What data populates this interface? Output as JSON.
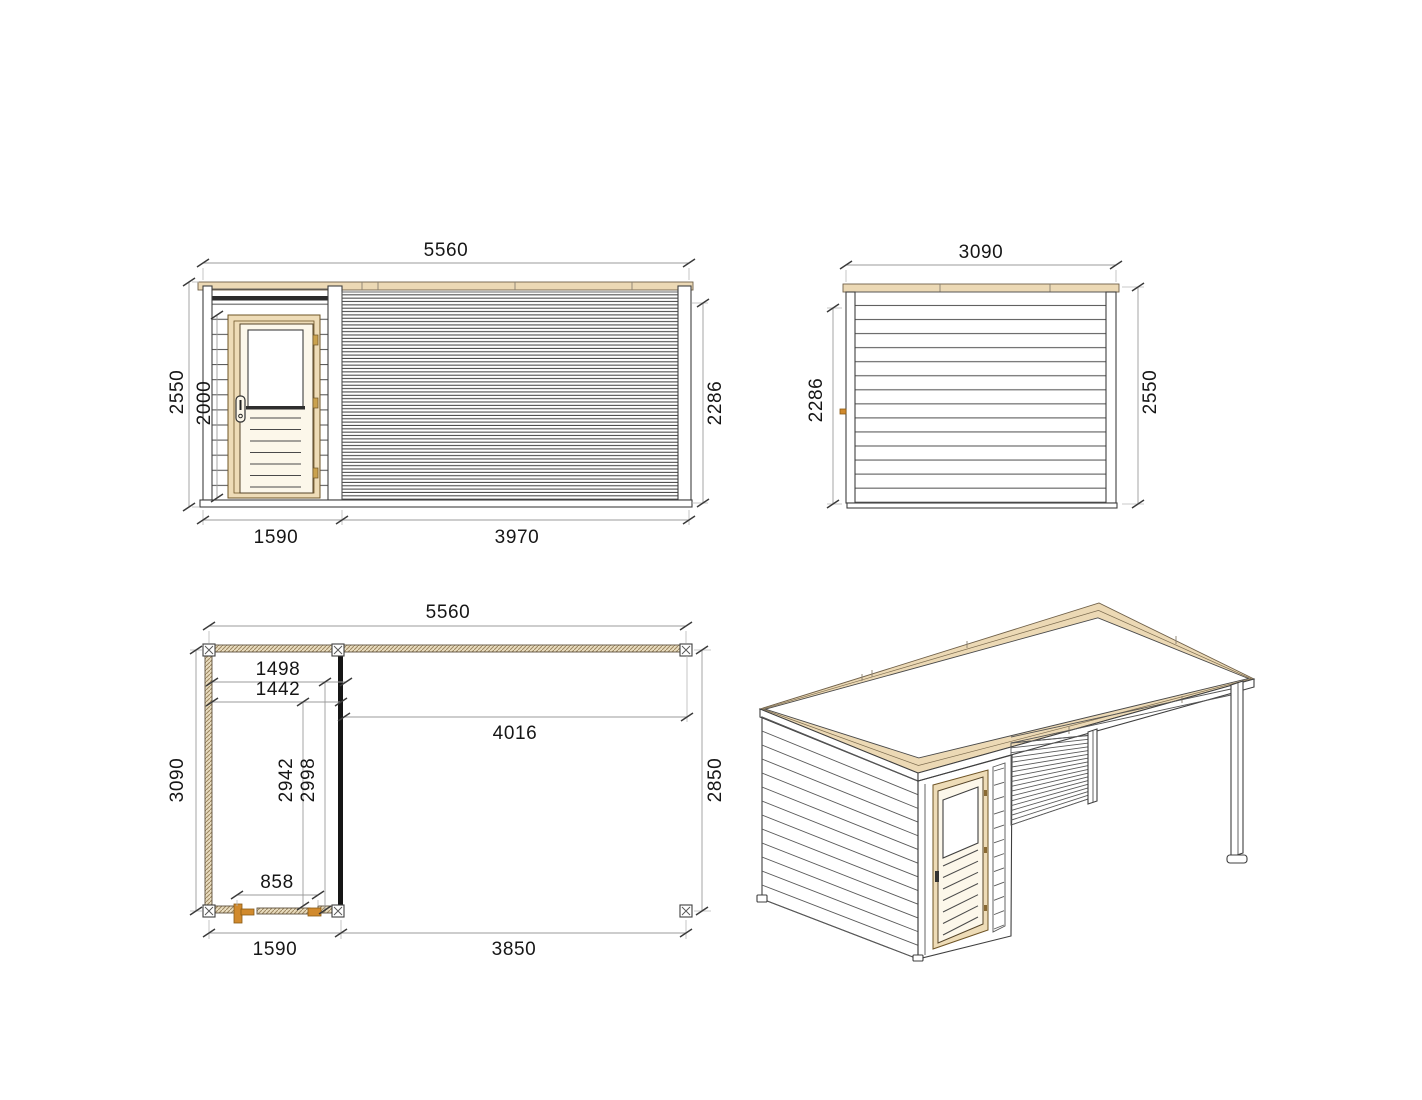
{
  "drawing": {
    "type": "technical-drawing-garden-room-with-pergola",
    "front_elevation": {
      "total_width": "5560",
      "total_height": "2550",
      "door_height": "2000",
      "wall_height": "2286",
      "room_width": "1590",
      "pergola_width": "3970"
    },
    "side_elevation": {
      "total_width": "3090",
      "wall_height": "2286",
      "total_height": "2550"
    },
    "floor_plan": {
      "total_width": "5560",
      "room_inner_width_a": "1498",
      "room_inner_width_b": "1442",
      "pergola_inner_length": "4016",
      "total_depth": "3090",
      "room_inner_depth_a": "2942",
      "room_inner_depth_b": "2998",
      "pergola_depth": "2850",
      "door_width": "858",
      "room_width": "1590",
      "pergola_length": "3850"
    },
    "colors": {
      "wood_light": "#ecd9b5",
      "wood_accent": "#d18a2d",
      "drawing_line": "#3f3f3f",
      "dimension_line": "#9b9b9b",
      "text": "#161616",
      "background": "#ffffff"
    }
  }
}
